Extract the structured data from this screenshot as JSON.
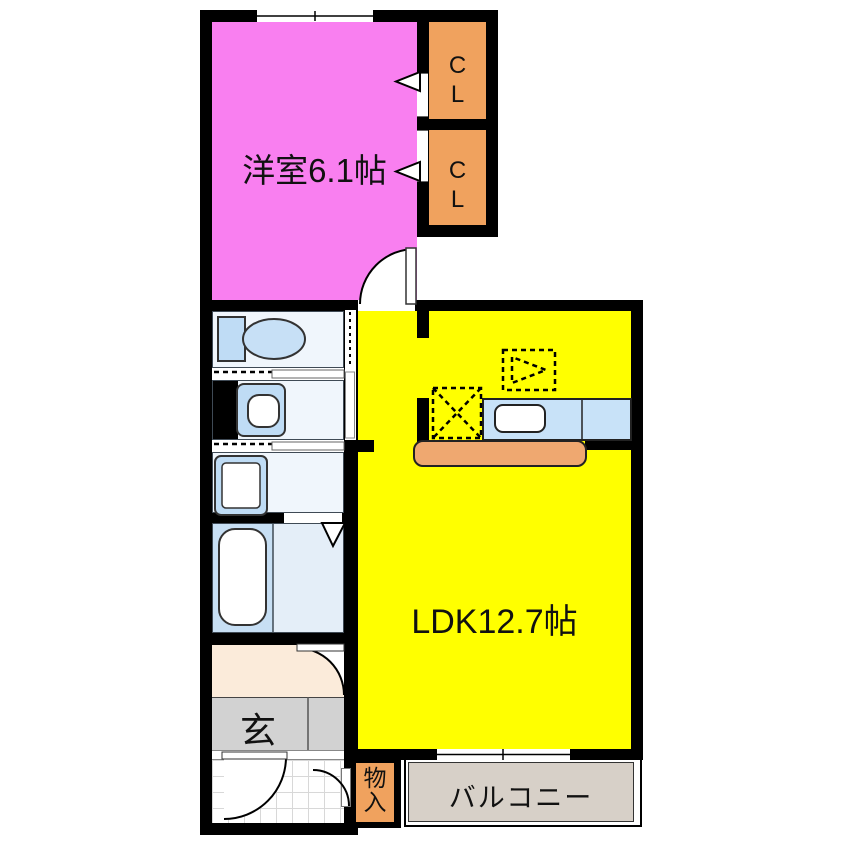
{
  "floorplan": {
    "title": "1LDK apartment floor plan",
    "rooms": {
      "bedroom": {
        "label": "洋室6.1帖"
      },
      "ldk": {
        "label": "LDK12.7帖"
      },
      "closet_upper": {
        "label": "CL"
      },
      "closet_lower": {
        "label": "CL"
      },
      "entrance": {
        "label": "玄"
      },
      "storage": {
        "label": "物入"
      },
      "balcony": {
        "label": "バルコニー"
      }
    },
    "colors": {
      "wall_black": "#000000",
      "bedroom_pink": "#F97FF0",
      "closet_orange": "#F0A25E",
      "ldk_yellow": "#FFFF00",
      "kitchen_counter_blue": "#C8E2F8",
      "counter_orange": "#EFA870",
      "fixture_blue": "#BFDCF5",
      "sanitary_bg": "#F0F6FC",
      "bath_blue": "#C7DFF4",
      "bath_light_blue": "#E4EEF8",
      "hallway_cream": "#FBEBDA",
      "entrance_gray": "#D2D2D2",
      "balcony_tan": "#D7D0C8"
    }
  }
}
